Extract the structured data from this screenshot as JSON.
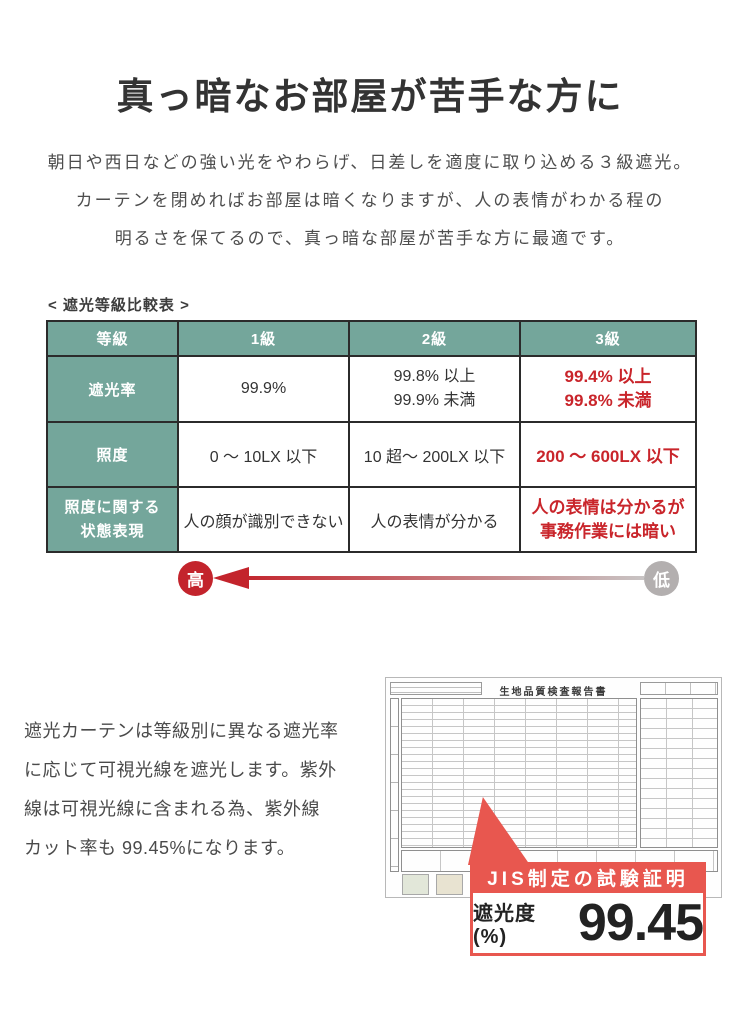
{
  "page": {
    "title": "真っ暗なお部屋が苦手な方に",
    "intro_lines": [
      "朝日や西日などの強い光をやわらげ、日差しを適度に取り込める３級遮光。",
      "カーテンを閉めればお部屋は暗くなりますが、人の表情がわかる程の",
      "明るさを保てるので、真っ暗な部屋が苦手な方に最適です。"
    ]
  },
  "comparison": {
    "label": "< 遮光等級比較表 >",
    "header": [
      "等級",
      "1級",
      "2級",
      "3級"
    ],
    "rows": [
      {
        "head": "遮光率",
        "cells": [
          "99.9%",
          "99.8% 以上\n99.9% 未満",
          "99.4% 以上\n99.8% 未満"
        ]
      },
      {
        "head": "照度",
        "cells": [
          "0 ～ 10LX 以下",
          "10 超～ 200LX 以下",
          "200 ～ 600LX 以下"
        ]
      },
      {
        "head": "照度に関する\n状態表現",
        "cells": [
          "人の顔が識別できない",
          "人の表情が分かる",
          "人の表情は分かるが\n事務作業には暗い"
        ]
      }
    ],
    "scale": {
      "high": "高",
      "low": "低"
    }
  },
  "description": {
    "text": "遮光カーテンは等級別に異なる遮光率\nに応じて可視光線を遮光します。紫外\n線は可視光線に含まれる為、紫外線\nカット率も 99.45%になります。"
  },
  "certificate": {
    "doc_title": "生地品質検査報告書",
    "badge_title": "JIS制定の試験証明",
    "metric_label": "遮光度(%)",
    "metric_value": "99.45"
  },
  "colors": {
    "table_green": "#74a69b",
    "table_border": "#2b2b2b",
    "highlight_red": "#c9252b",
    "scale_high_red": "#c3242c",
    "scale_low_gray": "#b3afaf",
    "badge_red": "#e8574f"
  }
}
